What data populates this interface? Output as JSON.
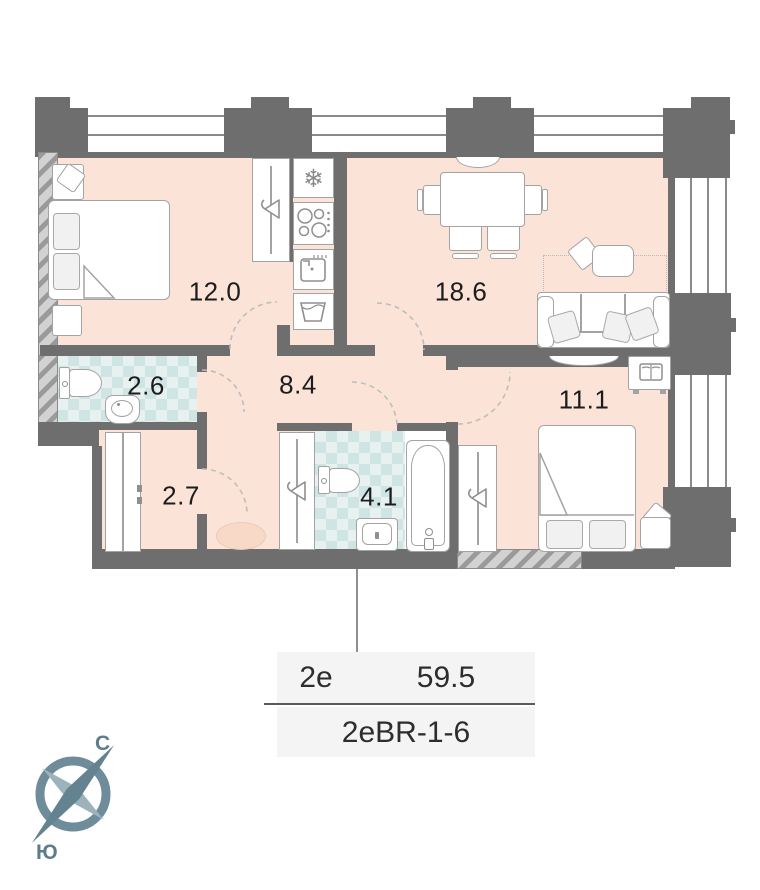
{
  "plan": {
    "rooms": [
      {
        "name": "bedroom",
        "area": "12.0"
      },
      {
        "name": "kitchen-living-room",
        "area": "18.6"
      },
      {
        "name": "bathroom-small",
        "area": "2.6"
      },
      {
        "name": "hallway",
        "area": "8.4"
      },
      {
        "name": "bedroom-2",
        "area": "11.1"
      },
      {
        "name": "wardrobe-room",
        "area": "2.7"
      },
      {
        "name": "bathroom-big",
        "area": "4.1"
      }
    ],
    "icons": {
      "fridge": "❄"
    }
  },
  "info_table": {
    "flat_type": "2e",
    "total_area": "59.5",
    "layout_code": "2eBR-1-6"
  },
  "compass": {
    "north": "С",
    "south": "Ю"
  },
  "colors": {
    "floor": "#fce3d8",
    "wet_floor": "#e7f1f0",
    "wall": "#6e6e6e",
    "table_bg": "#f4f4f4",
    "compass": "#5e7d8b"
  }
}
